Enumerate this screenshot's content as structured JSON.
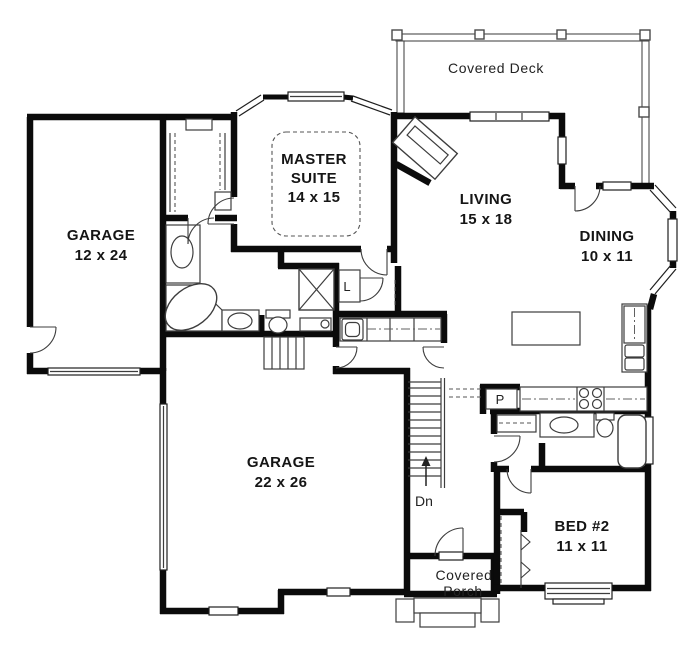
{
  "plan": {
    "background_color": "#ffffff",
    "wall_color": "#0b0b0b",
    "line_color": "#3d3d3d",
    "text_color": "#151515",
    "rooms": {
      "covered_deck": {
        "label": "Covered Deck"
      },
      "master_suite": {
        "line1": "MASTER",
        "line2": "SUITE",
        "dims": "14 x 15"
      },
      "living": {
        "label": "LIVING",
        "dims": "15 x 18"
      },
      "dining": {
        "label": "DINING",
        "dims": "10 x 11"
      },
      "garage_front": {
        "label": "GARAGE",
        "dims": "12 x 24"
      },
      "garage_main": {
        "label": "GARAGE",
        "dims": "22 x 26"
      },
      "bed_2": {
        "label": "BED #2",
        "dims": "11 x 11"
      },
      "covered_porch": {
        "line1": "Covered",
        "line2": "Porch"
      }
    },
    "annotations": {
      "stair_direction": "Dn",
      "linen_closet": "L",
      "pantry": "P"
    }
  }
}
